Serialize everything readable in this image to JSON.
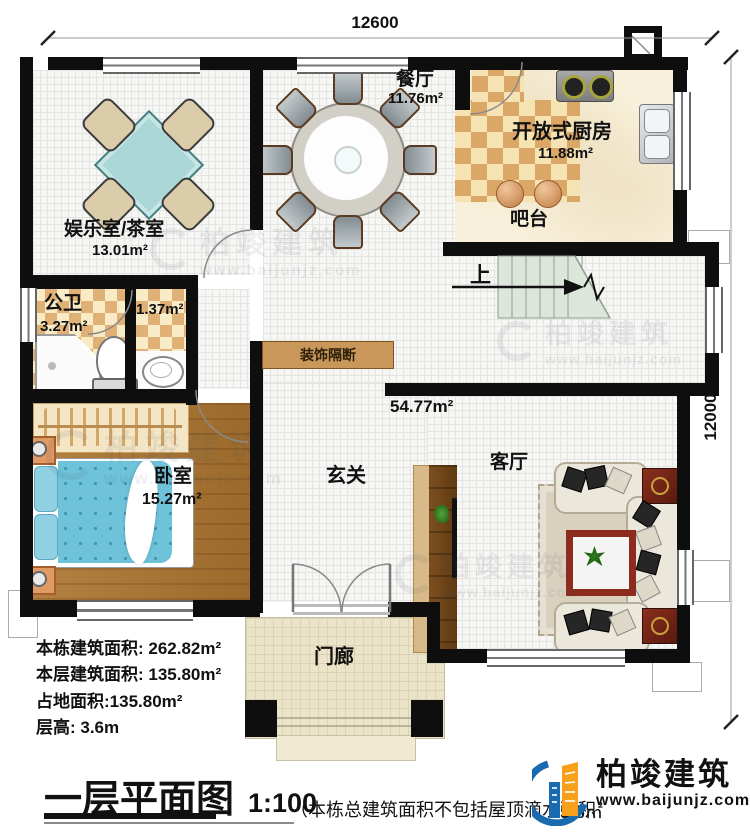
{
  "plan": {
    "title": "一层平面图",
    "scale": "1:100",
    "dim_top": "12600",
    "dim_right": "12000",
    "footnote_left": "（本栋总建筑面积不包括屋顶滴水面积",
    "footnote_right": "5.6㎡"
  },
  "stats": {
    "line1": "本栋建筑面积: 262.82m²",
    "line2": "本层建筑面积: 135.80m²",
    "line3": "占地面积:135.80m²",
    "line4": "层高: 3.6m"
  },
  "rooms": {
    "dining": {
      "name": "餐厅",
      "area": "11.76m²"
    },
    "kitchen": {
      "name": "开放式厨房",
      "area": "11.88m²"
    },
    "bar": {
      "name": "吧台"
    },
    "entertainment": {
      "name": "娱乐室/茶室",
      "area": "13.01m²"
    },
    "bath": {
      "name": "公卫",
      "area": "3.27m²"
    },
    "closet": {
      "area": "1.37m²"
    },
    "bedroom": {
      "name": "卧室",
      "area": "15.27m²"
    },
    "foyer": {
      "name": "玄关"
    },
    "living": {
      "name": "客厅"
    },
    "hall": {
      "area": "54.77m²"
    },
    "porch": {
      "name": "门廊"
    },
    "partition": {
      "name": "装饰隔断"
    },
    "stairs": {
      "direction": "上"
    }
  },
  "brand": {
    "name": "柏竣建筑",
    "url": "www.baijunjz.com"
  },
  "watermark": {
    "name": "柏竣建筑",
    "url": "www.baijunjz.com"
  }
}
